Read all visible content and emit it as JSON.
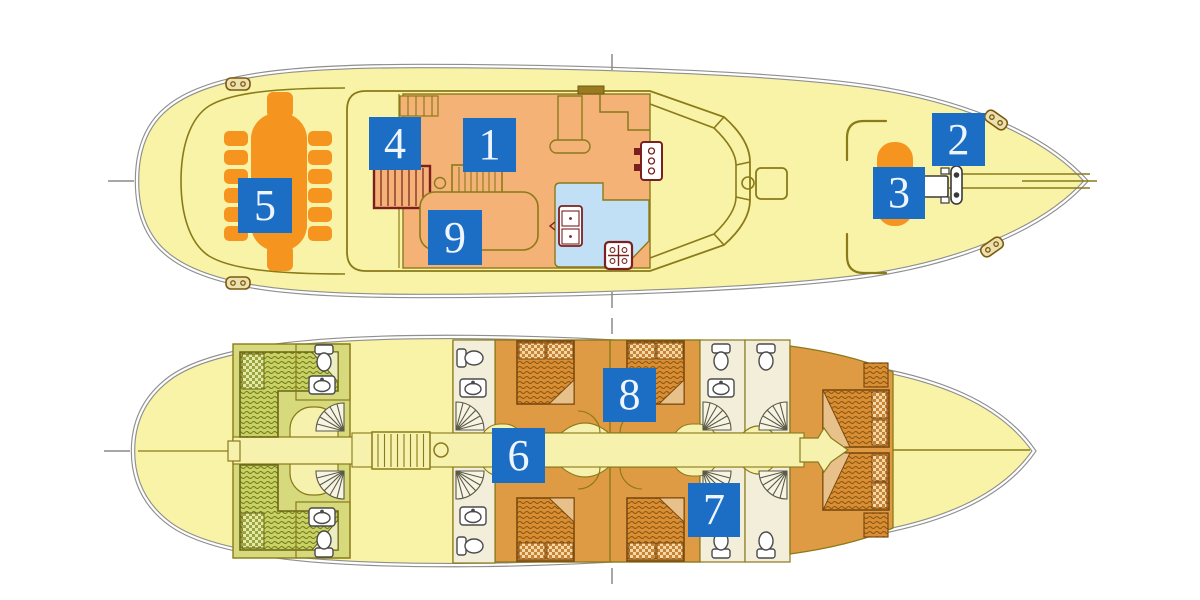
{
  "figure": {
    "type": "yacht-deck-plan",
    "decks": [
      "upper-deck",
      "lower-deck"
    ]
  },
  "markers": [
    {
      "label": "1"
    },
    {
      "label": "2"
    },
    {
      "label": "3"
    },
    {
      "label": "4"
    },
    {
      "label": "5"
    },
    {
      "label": "6"
    },
    {
      "label": "7"
    },
    {
      "label": "8"
    },
    {
      "label": "9"
    }
  ],
  "colors": {
    "marker_bg": "#1b6ec4",
    "marker_text": "#eef5ff",
    "hull_fill": "#f8f3a6",
    "hull_stroke": "#8f8f8f",
    "wall_outline": "#8a7a1a",
    "salon_fill": "#f4b277",
    "galley_fill": "#c2e0f5",
    "furniture_orange": "#f5941f",
    "cabin_orange": "#df9a44",
    "bed_orange": "#d98e33",
    "cabin_green": "#d6da7c",
    "bed_green": "#c9d163",
    "bathroom_cream": "#f2eeda",
    "corridor_pale": "#f6f1ad",
    "stove_red": "#7b2020",
    "bed_dark": "#7b4a10"
  }
}
